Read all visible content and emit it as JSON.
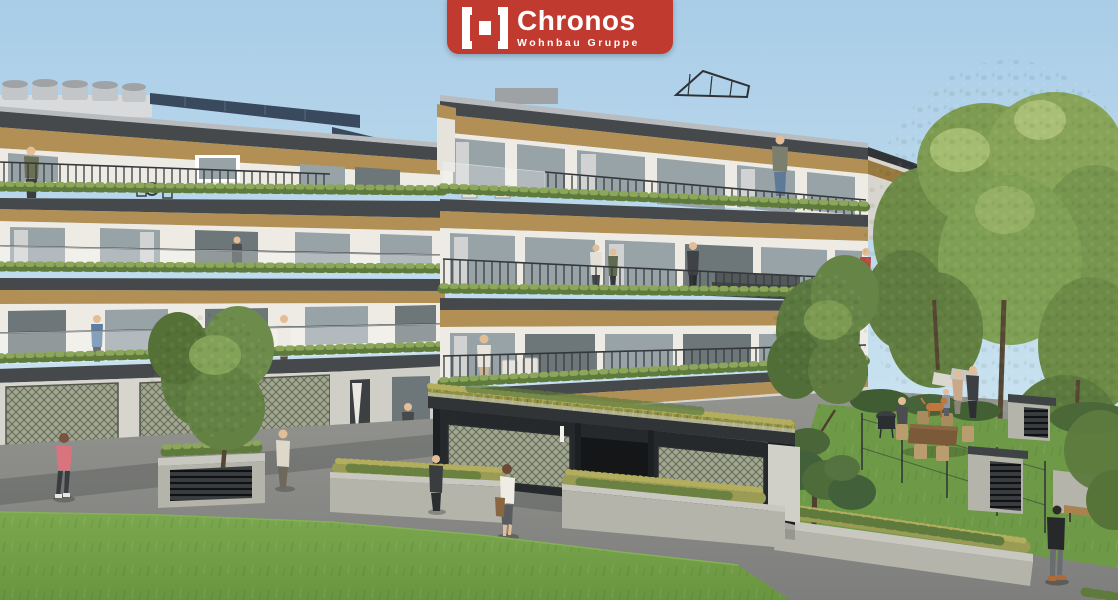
{
  "window": {
    "width": 1118,
    "height": 600
  },
  "logo": {
    "brand": "Chronos",
    "subtitle": "Wohnbau Gruppe",
    "icon": "bracket-square-icon",
    "background_color": "#c13a30",
    "text_color": "#ffffff"
  },
  "palette": {
    "logo_red": "#c13a30",
    "sky_top": "#a9cde7",
    "sky_bottom": "#dcecf5",
    "facade_white": "#edebe4",
    "facade_shadow": "#d7d5ce",
    "gold": "#b18f55",
    "gold_dark": "#97783f",
    "fascia_dark": "#45494c",
    "fascia_deep": "#303437",
    "glass": "#97a3a7",
    "glass_dark": "#6d7678",
    "concrete": "#b5b4ab",
    "concrete_light": "#c9c8c0",
    "mesh_olive": "#a2a792",
    "lawn_green": "#74a14a",
    "lawn_dark": "#658e3f",
    "asphalt": "#8d8e8c",
    "tree_green": "#7d9a52",
    "tree_dark": "#5c7840",
    "tree_light": "#a4bc70",
    "roof_grass": "#8e9045",
    "trunk_brown": "#564734"
  },
  "scene": {
    "type": "architectural-exterior-rendering",
    "subject": "Modern terraced residential complex with bronze fascia bands, planted balcony edges, rooftop solar panels, green-roof garage pavilion, lawn foreground, mature trees and private gardens at right",
    "sky": "clear light blue",
    "figures": [
      "terrace-man-far-left",
      "balcony-person-blue",
      "wing-balcony-walker",
      "wing-doorway-figure",
      "terrace-duo-a",
      "terrace-duo-b",
      "floor2-balcony-woman",
      "red-dress-woman",
      "penthouse-man",
      "floor3-terrace-woman",
      "courtyard-man",
      "courtyard-child",
      "garage-front-figure",
      "walker-with-bag",
      "jogger-pink",
      "ground-walker",
      "bbq-man",
      "garden-father",
      "garden-mother",
      "garden-child",
      "garden-dog",
      "path-man-bottom-right"
    ]
  }
}
